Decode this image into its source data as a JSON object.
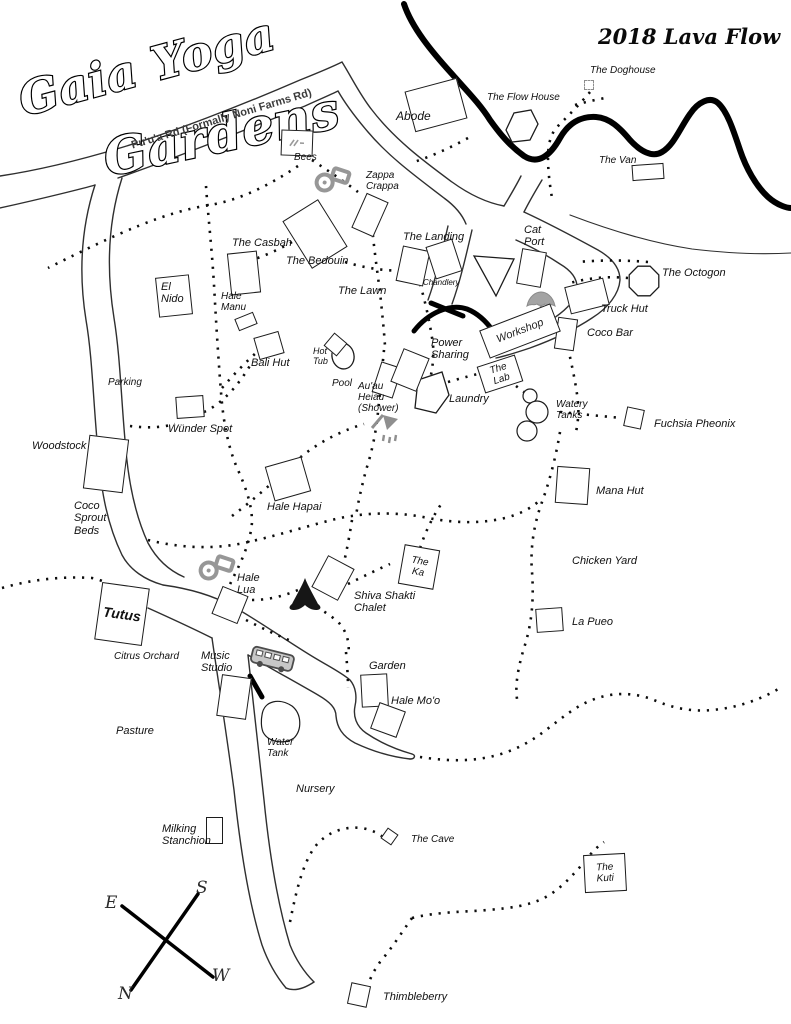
{
  "logo": {
    "line1": "Gaia Yoga",
    "line2": "Gardens"
  },
  "lava_label": "2018 Lava Flow",
  "road_label": "Pu'u'a Rd (Formally Noni Farms Rd)",
  "compass": {
    "top_left": "E",
    "top_right": "S",
    "bottom_left": "N",
    "bottom_right": "W"
  },
  "places": {
    "bees": "Bees",
    "abode": "Abode",
    "flow_house": "The Flow House",
    "doghouse": "The Doghouse",
    "van": "The Van",
    "zappa_crappa": "Zappa\nCrappa",
    "casbah": "The Casbah",
    "bedouin": "The Bedouin",
    "landing": "The Landing",
    "chandlery": "Chandlery",
    "cat_port": "Cat\nPort",
    "octogon": "The Octogon",
    "truck_hut": "Truck Hut",
    "coco_bar": "Coco Bar",
    "workshop": "Workshop",
    "lawn": "The Lawn",
    "el_nido": "El\nNido",
    "hale_manu": "Hale\nManu",
    "bali_hut": "Bali Hut",
    "hot_tub": "Hot\nTub",
    "pool": "Pool",
    "auau_heiau": "Au'au\nHeiau\n(Shower)",
    "power_sharing": "Power\nSharing",
    "laundry": "Laundry",
    "lab": "The\nLab",
    "watery_tanks": "Watery\nTanks",
    "fuchsia_pheonix": "Fuchsia Pheonix",
    "mana_hut": "Mana Hut",
    "parking": "Parking",
    "wunder_spot": "Wünder Spot",
    "woodstock": "Woodstock",
    "coco_sprout_beds": "Coco\nSprout\nBeds",
    "hale_hapai": "Hale Hapai",
    "chicken_yard": "Chicken Yard",
    "the_ka": "The\nKa",
    "hale_lua": "Hale\nLua",
    "shiva_shakti": "Shiva Shakti\nChalet",
    "la_pueo": "La Pueo",
    "tutus": "Tutus",
    "citrus_orchard": "Citrus Orchard",
    "music_studio": "Music\nStudio",
    "garden": "Garden",
    "hale_moo": "Hale Mo'o",
    "water_tank": "Water\nTank",
    "pasture": "Pasture",
    "nursery": "Nursery",
    "milking_stanchion": "Milking\nStanchion",
    "cave": "The Cave",
    "kuti": "The\nKuti",
    "thimbleberry": "Thimbleberry"
  }
}
